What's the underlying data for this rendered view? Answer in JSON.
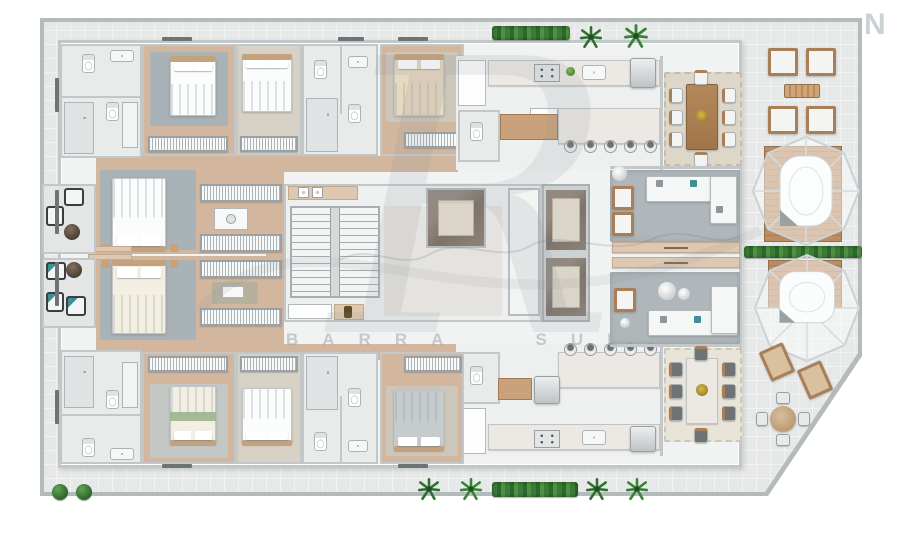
{
  "watermark": {
    "monogram": "R",
    "brand": "BARRA SUL",
    "corner_letter": "N"
  },
  "palette": {
    "plate": "#e7e9e8",
    "grid": "#d9dddc",
    "wall": "#c2c8ca",
    "building": "#f1f3f3",
    "room": "#e9ebea",
    "wood": "#d2b79e",
    "wood2": "#c9a27b",
    "carpet": "#a9b2b6",
    "carpet2": "#b0b7ba",
    "rug": "#ded6c8",
    "marble": "#ece9e4",
    "marbledark": "#867c72",
    "deck": "#bd8d62",
    "green": "#3c7c38",
    "tan": "#dfc8b1",
    "teal": "#3f8f96",
    "wm": "#aab0b4"
  },
  "legend": {
    "bed-icon": "rounded rect + pillows + headboard bar",
    "toilet-icon": "oval bowl + tank rect",
    "sink-icon": "rounded rect + drain dot",
    "shower-icon": "tiled square + drain",
    "wardrobe-icon": "striped rail rect",
    "sofa-icon": "L-shaped white rects",
    "dining-table-icon": "wood rect + 8 chairs",
    "bar-stool-icon": "circle with dark back",
    "lounge-chair-icon": "wood frame + cushion",
    "spa-dome-icon": "octagonal glazed dome over tub on deck",
    "stairs-icon": "striped treads with center rail",
    "elevator-icon": "dark marble cab with mat",
    "palm-icon": "green leaf rosette",
    "hedge-icon": "green textured strip",
    "washer-icon": "white square with round door"
  },
  "scene": {
    "units": [
      {
        "name": "upper apartment",
        "rooms": [
          "bathroom block",
          "bedroom 1",
          "bedroom 2",
          "bathroom",
          "bedroom 3",
          "master suite",
          "closet corridor",
          "kitchen",
          "powder room",
          "dining room",
          "living room",
          "private balcony"
        ]
      },
      {
        "name": "lower apartment",
        "rooms": [
          "bathroom block",
          "bedroom 1",
          "bedroom 2",
          "bathroom",
          "bedroom 3",
          "master suite",
          "closet corridor",
          "kitchen",
          "powder room",
          "dining room",
          "living room",
          "private balcony"
        ]
      }
    ],
    "core": [
      "staircase",
      "lobby hall",
      "marble foyer",
      "corridor",
      "elevator 1",
      "elevator 2",
      "laundry counters"
    ],
    "terrace": [
      "four lounge chairs",
      "slatted table",
      "upper spa dome on deck",
      "hedge divider",
      "lower spa dome on deck",
      "two sun loungers",
      "round outdoor dining set"
    ],
    "landscaping": [
      "top hedge planter",
      "palm trees",
      "bottom hedge planter",
      "two bushes"
    ]
  }
}
